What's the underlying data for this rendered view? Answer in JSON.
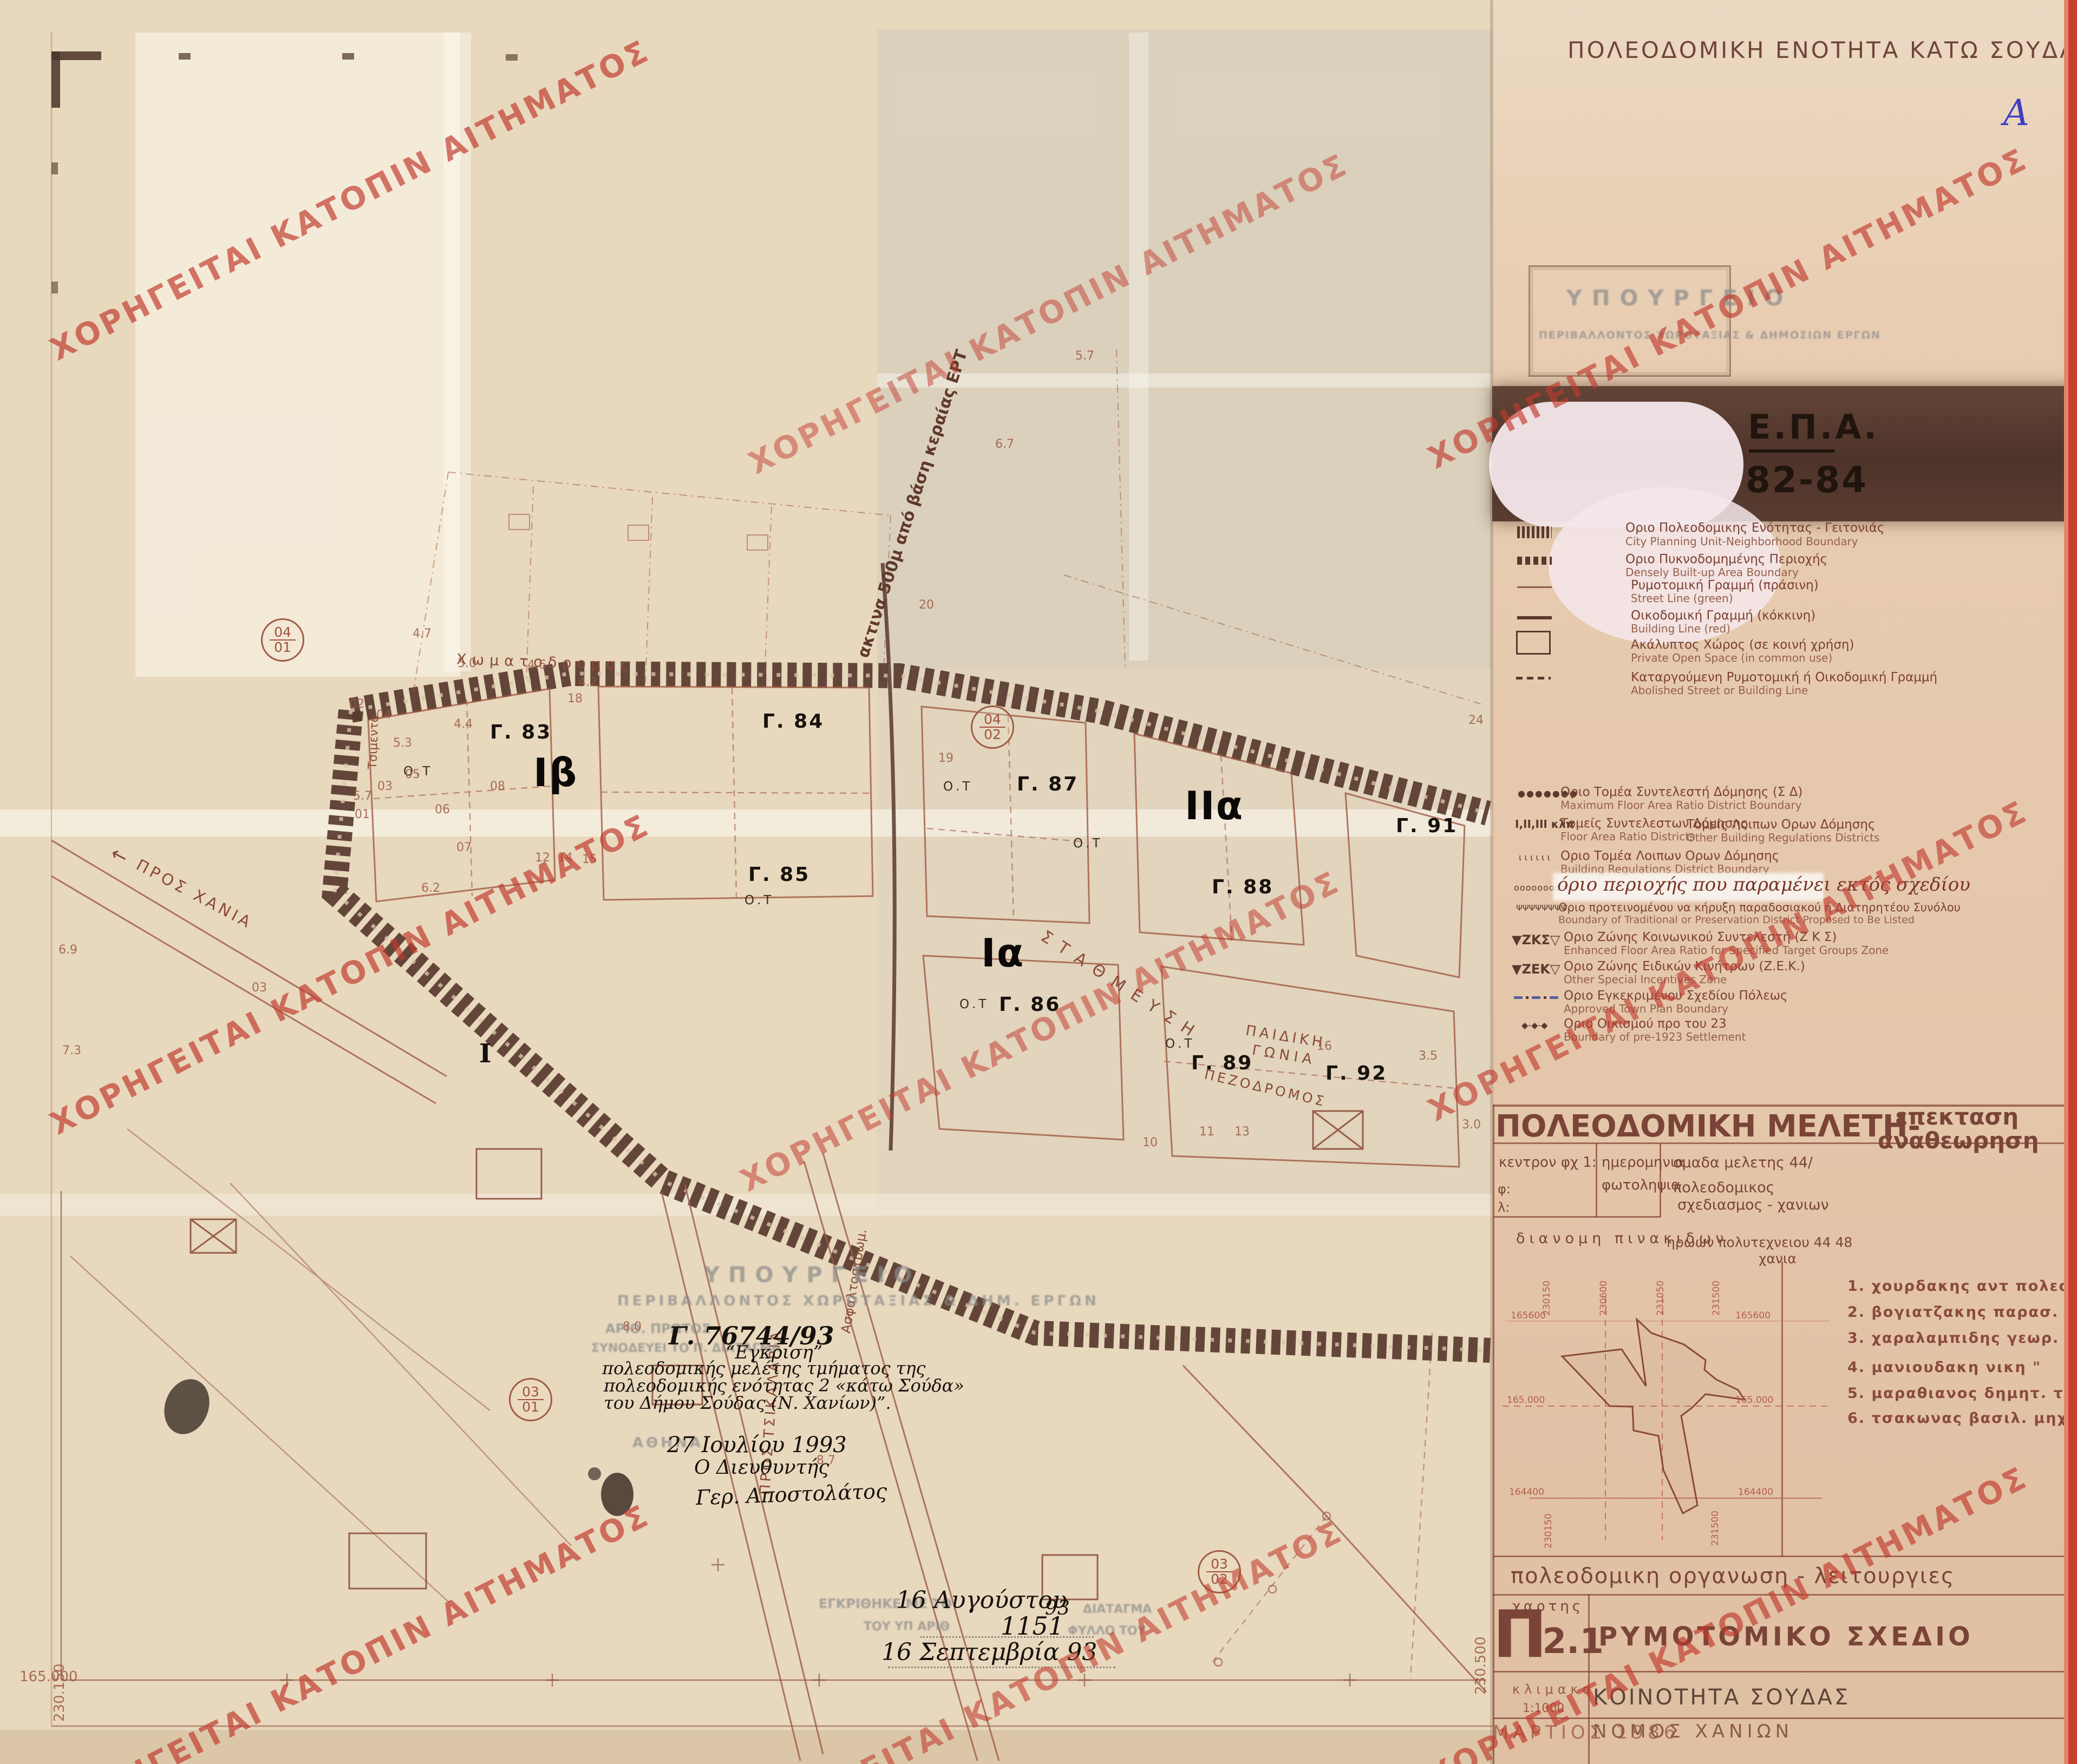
{
  "watermark": {
    "text": "ΧΟΡΗΓΕΙΤΑΙ ΚΑΤΟΠΙΝ ΑΙΤΗΜΑΤΟΣ"
  },
  "header": {
    "title": "ΠΟΛΕΟΔΟΜΙΚΗ  ΕΝΟΤΗΤΑ  ΚΑΤΩ  ΣΟΥΔΑΣ",
    "corner_mark": "Α"
  },
  "stamp_box": {
    "line1": "ΥΠΟΥΡΓΕΙΟ",
    "line2": "ΠΕΡΙΒΑΛΛΟΝΤΟΣ  ΧΩΡΟΤΑΞΙΑΣ  &  ΔΗΜΟΣΙΩΝ  ΕΡΓΩΝ"
  },
  "epa_band": {
    "title": "Ε.Π.Α.",
    "years": "82-84"
  },
  "legend_a": {
    "items": [
      {
        "gr": "Οριο Πολεοδομικης Ενότητας - Γειτονιάς",
        "en": "City Planning Unit-Neighborhood Boundary"
      },
      {
        "gr": "Οριο Πυκνοδομημένης Περιοχής",
        "en": "Densely Built-up Area Boundary"
      },
      {
        "gr": "Ρυμοτομική Γραμμή (πράσινη)",
        "en": "Street Line (green)"
      },
      {
        "gr": "Οικοδομική Γραμμή (κόκκινη)",
        "en": "Building Line (red)"
      },
      {
        "gr": "Ακάλυπτος Χώρος (σε κοινή χρήση)",
        "en": "Private Open Space (in common use)"
      },
      {
        "gr": "Καταργούμενη Ρυμοτομική ή Οικοδομική Γραμμή",
        "en": "Abolished Street or Building Line"
      }
    ]
  },
  "legend_b": {
    "items": [
      {
        "sym": "●●●●●●●",
        "gr": "Οριο Τομέα Συντελεστή Δόμησης (Σ Δ)",
        "en": "Maximum Floor Area Ratio District Boundary"
      },
      {
        "sym": "Ι,ΙΙ,ΙΙΙ κλπ",
        "gr": "Τομείς Συντελεστων Δόμησης",
        "en": "Floor Area Ratio Districts",
        "gr2": "Τομείς Λοιπων  Ορων Δόμησης",
        "en2": "Other Building Regulations Districts"
      },
      {
        "sym": "ι ι ι ι ι ι",
        "gr": "Οριο Τομέα Λοιπων  Ορων Δόμησης",
        "en": "Building Regulations   District Boundary"
      },
      {
        "sym": "oooooooooo",
        "gr": "όριο περιοχής που παραμένει εκτός σχεδίου",
        "en": ""
      },
      {
        "sym": "ΨΨΨΨΨΨΨΨ",
        "gr": "Οριο προτεινομένου να κήρυξη παραδοσιακού ή Διατηρητέου Συνόλου",
        "en": "Boundary of Traditional or Preservation District Proposed to Be Listed"
      },
      {
        "sym": "▼ΖΚΣ▽",
        "gr": "Οριο Ζώνης Κοινωνικού Συντελεστή (Ζ Κ Σ)",
        "en": "Enhanced Floor Area Ratio for Specified Target Groups Zone"
      },
      {
        "sym": "▼ΖΕΚ▽",
        "gr": "Οριο Ζώνης Ειδικών Κινήτρων (Ζ.Ε.Κ.)",
        "en": "Other Special Incentives Zone"
      },
      {
        "sym": "",
        "gr": "Οριο Εγκεκριμένου Σχεδίου Πόλεως",
        "en": "Approved Town Plan Boundary"
      },
      {
        "sym": "◆-◆-◆",
        "gr": "Οριο Οικισμού προ του  23",
        "en": "Boundary of pre-1923 Settlement"
      }
    ]
  },
  "titleblock": {
    "header": "ΠΟΛΕΟΔΟΜΙΚΗ ΜΕΛΕΤΗ-",
    "header_sub1": "επεκταση",
    "header_sub2": "αναθεωρηση",
    "c1_l1": "κεντρον φχ 1:",
    "c1_l2": "φ:",
    "c1_l3": "λ:",
    "c2_l1": "ημερομηνια",
    "c2_l2": "φωτοληψια",
    "c3_l1": "ομαδα  μελετης  44/",
    "c3_l2": "πολεοδομικος",
    "c3_l3": "σχεδιασμος - χανιων",
    "dist": "διανομη     πινακιδων",
    "addr1": "ηρωων  πολυτεχνειου  44 48",
    "addr2": "χανια",
    "org_row": "πολεοδομικη  οργανωση - λειτουργιες",
    "map_label": "χαρτης",
    "map_glyph": "Π",
    "map_code": "-2.1",
    "map_type": "ΡΥΜΟΤΟΜΙΚΟ ΣΧΕΔΙΟ",
    "scale_label": "κλιμακα",
    "scale_value": "1:1000",
    "community": "ΚΟΙΝΟΤΗΤΑ  ΣΟΥΔΑΣ",
    "date": "ΜΑΡΤΙΟΣ   1986",
    "prefecture": "ΝΟΜΟΣ  ΧΑΝΙΩΝ"
  },
  "team": {
    "items": [
      "1.  χουρδακης  αντ  πολεοδ",
      "2.  βογιατζακης  παρασ. \"",
      "3.  χαραλαμπιδης  γεωρ. αρχ",
      "4.  μανιουδακη  νικη      \"",
      "5.  μαραθιανος  δημητ. τοπ",
      "6.  τσακωνας  βασιλ.  μηχαν"
    ]
  },
  "inset": {
    "top": [
      "230150",
      "230600",
      "231050",
      "231500"
    ],
    "left": [
      "165600",
      "165.000",
      "164400"
    ],
    "right": [
      "165600",
      "165.000",
      "164400"
    ],
    "bottom": [
      "230150",
      "231500"
    ]
  },
  "map": {
    "blocks": [
      "Γ. 83",
      "Γ. 84",
      "Γ. 85",
      "Γ. 86",
      "Γ. 87",
      "Γ. 88",
      "Γ. 89",
      "Γ. 91",
      "Γ. 92"
    ],
    "zones": [
      "Ιβ",
      "Ια",
      "ΙΙα"
    ],
    "ot_label": "Ο.Τ",
    "monument": "Ι",
    "circles": [
      {
        "n": "04",
        "d": "01"
      },
      {
        "n": "04",
        "d": "02"
      },
      {
        "n": "03",
        "d": "01"
      },
      {
        "n": "03",
        "d": "02"
      }
    ],
    "streets": {
      "top_road": "Χωματοδρομος",
      "parking": "ΣΤΑΘΜΕΥΣΗ",
      "pedestrian": "ΠΕΖΟΔΡΟΜΟΣ",
      "playground1": "ΠΑΙΔΙΚΗ",
      "playground2": "ΓΩΝΙΑ",
      "to_chania": "ΠΡΟΣ ΧΑΝΙΑ",
      "arrow": "←",
      "to_tsikalaria": "ΠΡΟΣ  ΤΣΙΚΑΛΑΡΙΑ",
      "asphalt": "Ασφαλτοστρωμ.",
      "cement": "Τσιμεντο",
      "radius_note": "ακτινα 500μ από βάση κεραίας ΕΡΤ"
    },
    "approval": {
      "ref": "Γ. 76744/93",
      "l1": "“Εγκριση”",
      "l2": "πολεοδομικής μελέτης τμήματος της",
      "l3": "πολεοδομικής ενότητας 2 «κάτω Σούδα»",
      "l4": "του Δήμου Σούδας (Ν. Χανίων)”.",
      "date": "27 Ιουλίου 1993",
      "role": "Ο Διευθυντής",
      "signature": "Γερ. Αποστολάτος"
    },
    "faded_stamp": {
      "ministry1": "ΥΠΟΥΡΓΕΙΟ",
      "ministry2": "ΠΕΡΙΒΑΛΛΟΝΤΟΣ  ΧΩΡΟΤΑΞΙΑΣ  &  ΔΗΜ.  ΕΡΓΩΝ",
      "protocol": "ΑΡΙΘ. ΠΡΩΤΟΣ",
      "accompanies": "ΣΥΝΟΔΕΥΕΙ ΤΟ Π. ΔΙΑΤΑΓΜΑ",
      "athens": "ΑΘΗΝΑ",
      "approved": "ΕΓΚΡΙΘΗΚΕ ΜΕ ΤΟ",
      "under_no": "ΤΟΥ ΥΠ ΑΡΙΘ",
      "sheet": "ΦΥΛΛΟ ΤΟΥ",
      "decree": "ΔΙΑΤΑΓΜΑ"
    },
    "dates": {
      "d1": "16 Αυγούστου",
      "d1_year": "93",
      "number": "1151",
      "d2": "16 Σεπτεμβρία 93"
    },
    "coords": {
      "bottom_left_h": "165.000",
      "bottom_left_v": "230.150",
      "bottom_right_v": "230.500"
    },
    "small_nums": [
      "02",
      "04",
      "03",
      "01",
      "05",
      "06",
      "07",
      "08",
      "18",
      "12",
      "14",
      "15",
      "19",
      "24",
      "16",
      "20",
      "10",
      "11",
      "13",
      "03",
      "4.7",
      "5.0",
      "4.4",
      "5.3",
      "5.7",
      "6.2",
      "4.6",
      "4.2",
      "8.0",
      "8.7",
      "6.7",
      "5.7",
      "7.3",
      "6.9",
      "3.5",
      "3.0"
    ]
  }
}
